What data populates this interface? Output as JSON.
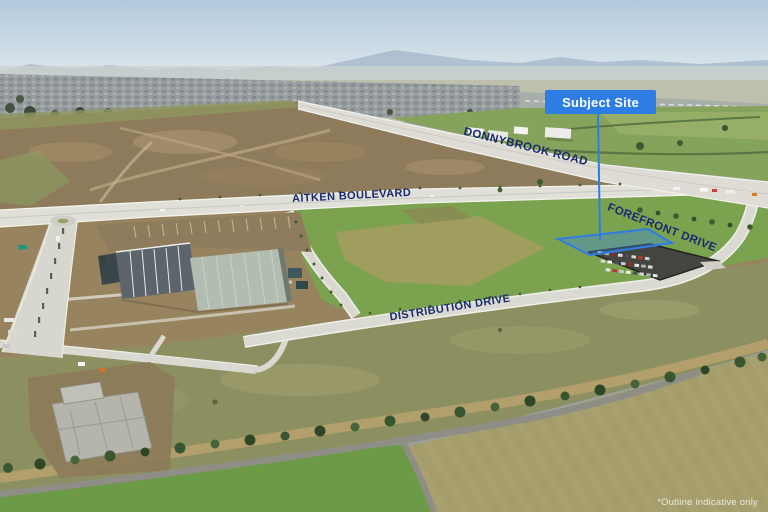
{
  "labels": {
    "subject_site": "Subject Site",
    "disclaimer": "*Outline indicative only"
  },
  "roads": {
    "donnybrook": "DONNYBROOK ROAD",
    "aitken": "AITKEN BOULEVARD",
    "forefront": "FOREFRONT DRIVE",
    "distribution": "DISTRIBUTION DRIVE"
  },
  "colors": {
    "accent": "#2e7de4",
    "site_fill": "#3c86e6",
    "road_label_navy": "#1b2a6e",
    "label_text": "#ffffff"
  }
}
